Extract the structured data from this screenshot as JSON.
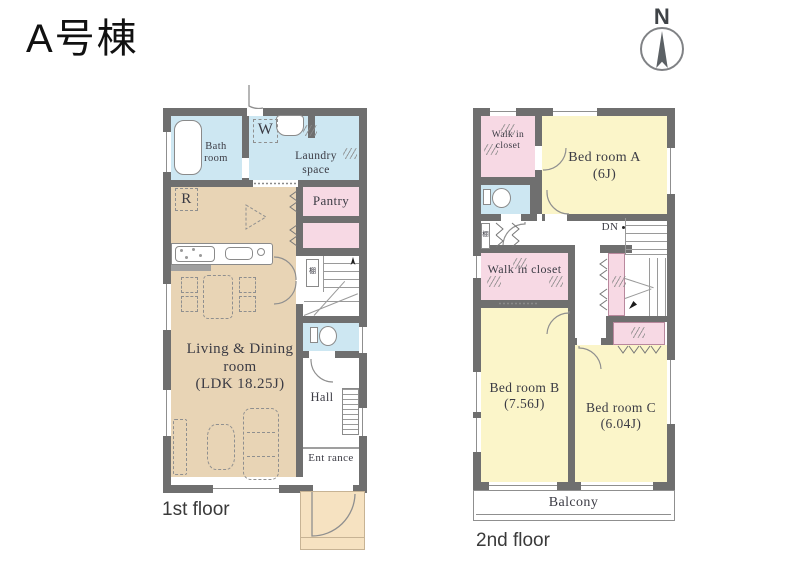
{
  "title": "A号棟",
  "compass": {
    "north_label": "N"
  },
  "colors": {
    "wall": "#6f6f6f",
    "water_blue": "#cde7f2",
    "closet_pink": "#f7d9e4",
    "ldk_tan": "#e8d4b5",
    "bedroom_yellow": "#fbf5c9",
    "porch_tan": "#f6e2c1"
  },
  "floor1": {
    "caption": "1st floor",
    "rooms": {
      "bath": {
        "label": "Bath room"
      },
      "washroom": {
        "label": "W"
      },
      "laundry": {
        "label": "Laundry space"
      },
      "pantry": {
        "label": "Pantry"
      },
      "refrigerator": {
        "label": "R"
      },
      "shelf": {
        "label": "棚"
      },
      "ldk": {
        "name_line1": "Living & Dining",
        "name_line2": "room",
        "size": "(LDK 18.25J)"
      },
      "hall": {
        "label": "Hall"
      },
      "entrance": {
        "label": "Ent rance"
      }
    }
  },
  "floor2": {
    "caption": "2nd floor",
    "rooms": {
      "walk_in_closet_a": {
        "label": "Walk in closet"
      },
      "walk_in_closet_b": {
        "label": "Walk in closet"
      },
      "bedroom_a": {
        "name": "Bed room A",
        "size": "(6J)"
      },
      "bedroom_b": {
        "name": "Bed room B",
        "size": "(7.56J)"
      },
      "bedroom_c": {
        "name": "Bed room C",
        "size": "(6.04J)"
      },
      "stairs_down": {
        "label": "DN"
      },
      "shelf": {
        "label": "棚"
      },
      "balcony": {
        "label": "Balcony"
      }
    }
  }
}
